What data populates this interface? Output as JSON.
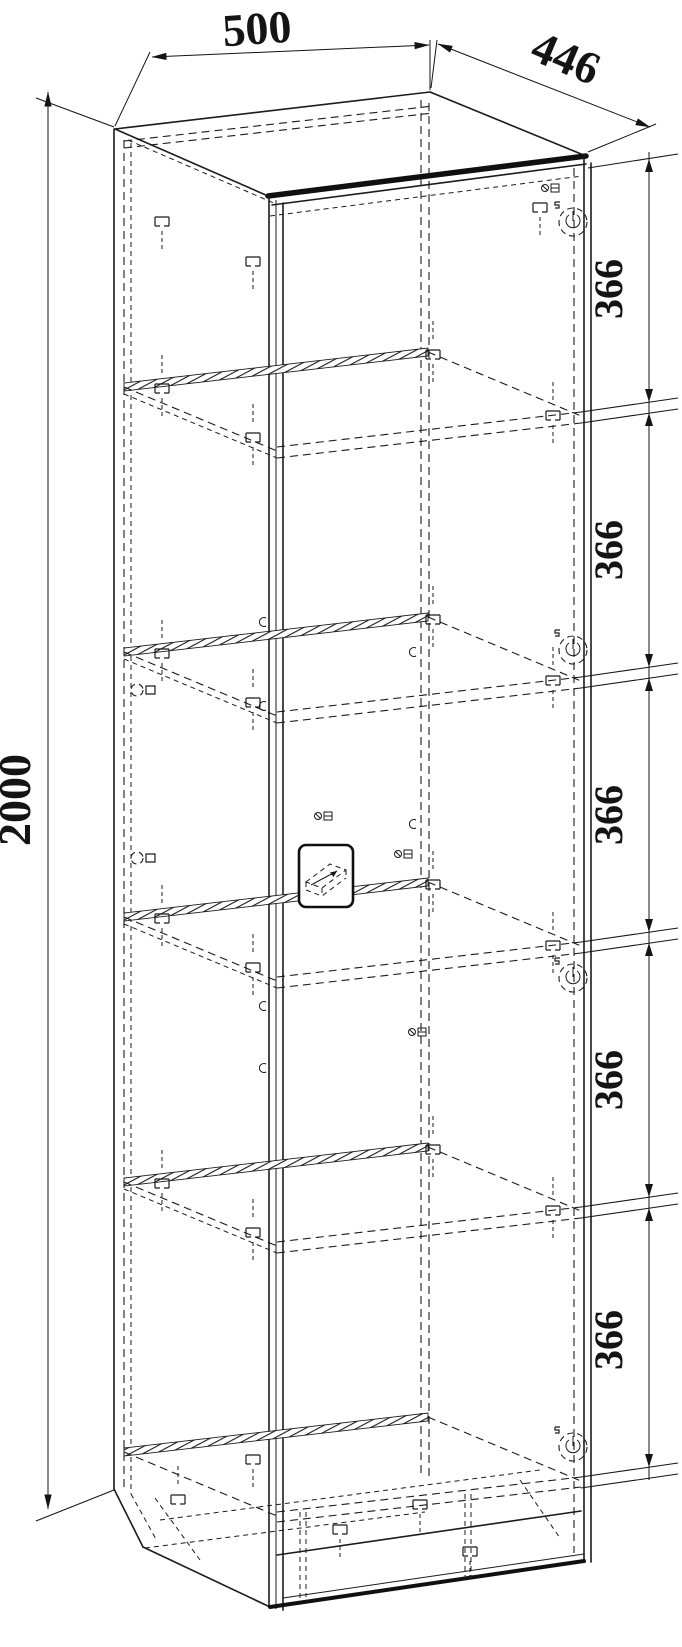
{
  "drawing": {
    "title": "cabinet-assembly-dimension-drawing",
    "dimensions": {
      "width": "500",
      "depth": "446",
      "height": "2000",
      "shelf_spacings": [
        "366",
        "366",
        "366",
        "366",
        "366"
      ]
    },
    "colors": {
      "line": "#1b1b1b",
      "background": "#ffffff"
    }
  }
}
